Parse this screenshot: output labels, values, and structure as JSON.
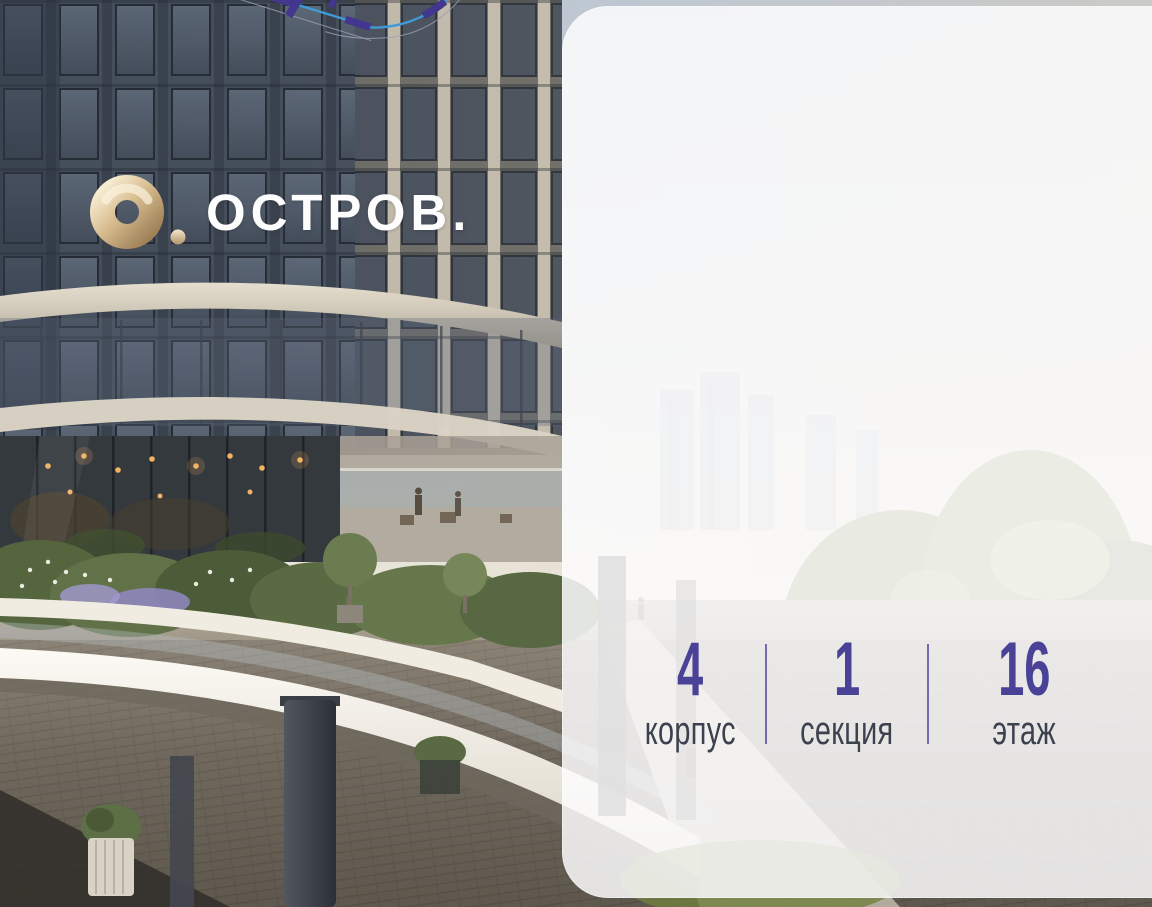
{
  "brand": {
    "name": "ОСТРОВ."
  },
  "unit_info": {
    "items": [
      {
        "value": "4",
        "label": "корпус"
      },
      {
        "value": "1",
        "label": "секция"
      },
      {
        "value": "16",
        "label": "этаж"
      }
    ]
  },
  "floor_plan": {
    "highlighted_unit": "selected-apartment"
  },
  "colors": {
    "accent": "#4a4297",
    "wall": "#42368f",
    "highlight": "#a99df0",
    "glass": "#3f9bd8",
    "glass_bright": "#56c8ee",
    "label": "#3b414d",
    "divider": "#5a55a8",
    "logo_gold": "#ccb184"
  }
}
